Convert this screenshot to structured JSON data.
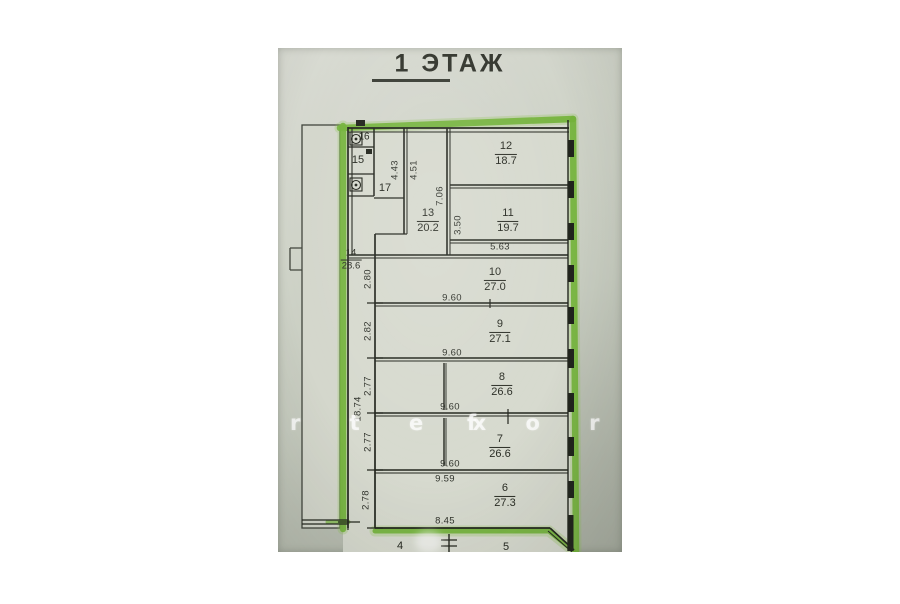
{
  "page": {
    "title": "1 ЭТАЖ"
  },
  "watermark": {
    "part1": "r t e x",
    "part2": "f o r t e"
  },
  "rooms": {
    "r16": {
      "number": "16"
    },
    "r15": {
      "number": "15"
    },
    "r17": {
      "number": "17"
    },
    "r13": {
      "number": "13",
      "area": "20.2"
    },
    "r12": {
      "number": "12",
      "area": "18.7"
    },
    "r11": {
      "number": "11",
      "area": "19.7"
    },
    "r14": {
      "number": "14",
      "area": "28.6"
    },
    "r10": {
      "number": "10",
      "area": "27.0"
    },
    "r9": {
      "number": "9",
      "area": "27.1"
    },
    "r8": {
      "number": "8",
      "area": "26.6"
    },
    "r7": {
      "number": "7",
      "area": "26.6"
    },
    "r6": {
      "number": "6",
      "area": "27.3"
    },
    "r4": {
      "number": "4"
    },
    "r5": {
      "number": "5"
    }
  },
  "dimensions": {
    "d_443": "4.43",
    "d_451": "4.51",
    "d_706": "7.06",
    "d_350": "3.50",
    "d_563": "5.63",
    "d_280": "2.80",
    "d_282": "2.82",
    "d_277a": "2.77",
    "d_277b": "2.77",
    "d_278": "2.78",
    "d_1874": "18.74",
    "d_960a": "9.60",
    "d_960b": "9.60",
    "d_960c": "9.60",
    "d_960d": "9.60",
    "d_959": "9.59",
    "d_845": "8.45"
  },
  "colors": {
    "marker_green": "#76b43e",
    "wall": "#23261e",
    "paper": "#d6d9ce"
  }
}
